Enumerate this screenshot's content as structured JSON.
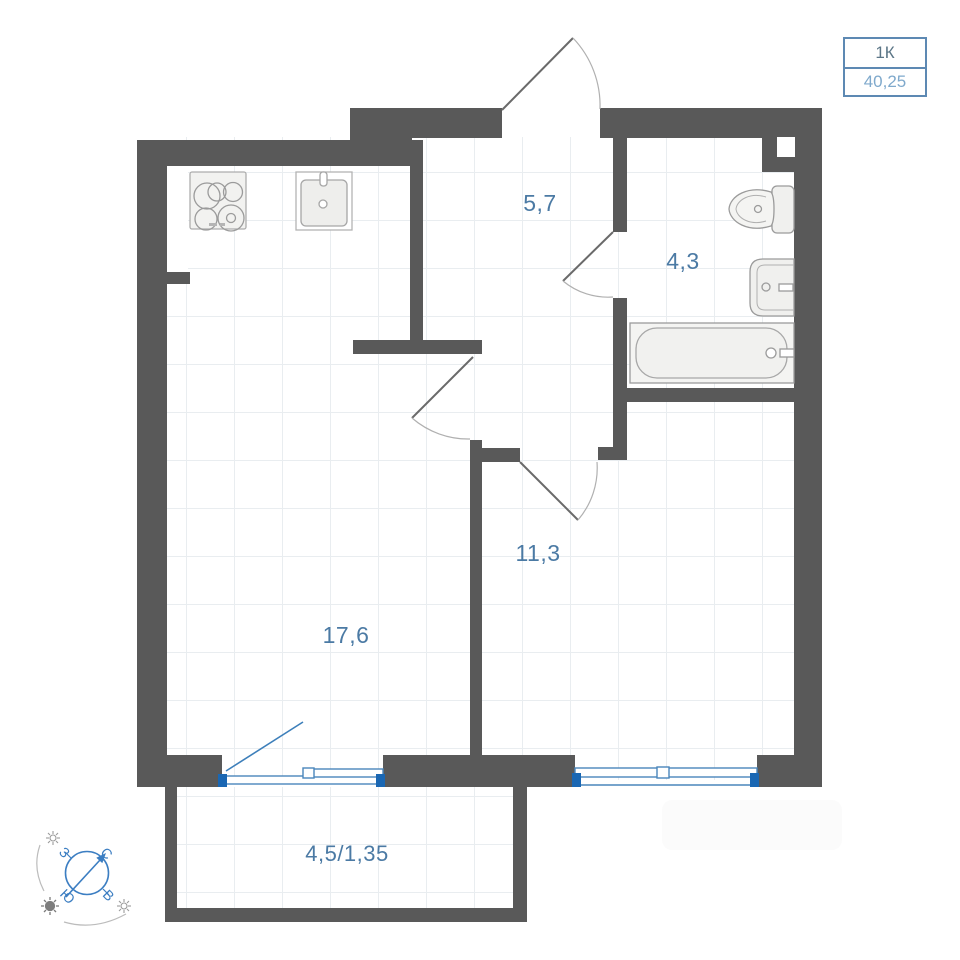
{
  "plan": {
    "legend": {
      "type": "1К",
      "area": "40,25"
    },
    "rooms": {
      "hallway": "5,7",
      "bathroom": "4,3",
      "bedroom": "11,3",
      "living_kitchen": "17,6",
      "balcony": "4,5/1,35"
    },
    "compass": {
      "north": "С",
      "east": "В",
      "south": "Ю",
      "west": "З"
    },
    "colors": {
      "wall": "#595959",
      "grid": "#e9edf0",
      "label_blue": "#4b7aa4",
      "window_blue": "#4a86bb",
      "window_cap_blue": "#1a67b3",
      "compass_blue": "#3c7ec2",
      "legend_border": "#5d89b3"
    },
    "fixtures": [
      "stove",
      "kitchen-sink",
      "toilet",
      "bathroom-sink",
      "bathtub"
    ]
  }
}
